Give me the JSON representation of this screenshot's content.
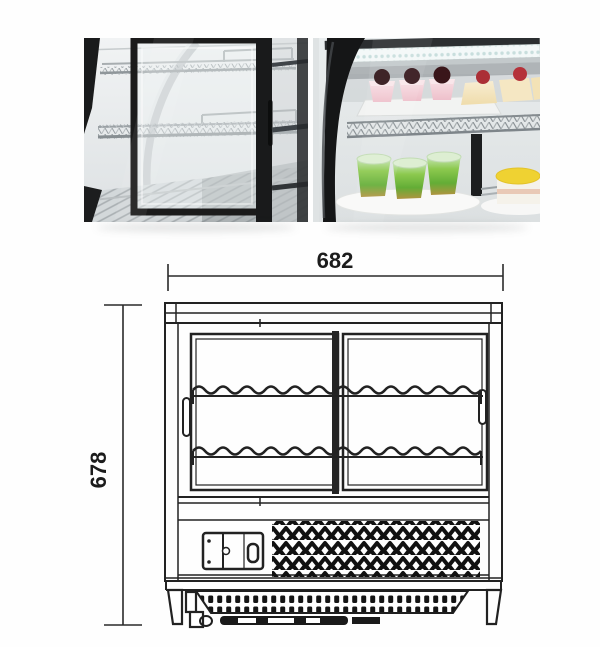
{
  "diagram": {
    "width_mm": "682",
    "height_mm": "678"
  },
  "photos": {
    "left_name": "rear-sliding-glass-doors-with-wire-shelves",
    "right_name": "curved-glass-front-with-led-light-and-desserts"
  },
  "palette": {
    "line_color": "#222222",
    "frame_black": "#151617",
    "glass_gray": "#e8ecee",
    "dessert_pink": "#f3cdd6",
    "cherry_dark": "#32131a",
    "cherry_red": "#ab3038",
    "jelly_green": "#7cc244",
    "cream_yellow": "#f3e2b8",
    "cake_top_yellow": "#efd232"
  }
}
